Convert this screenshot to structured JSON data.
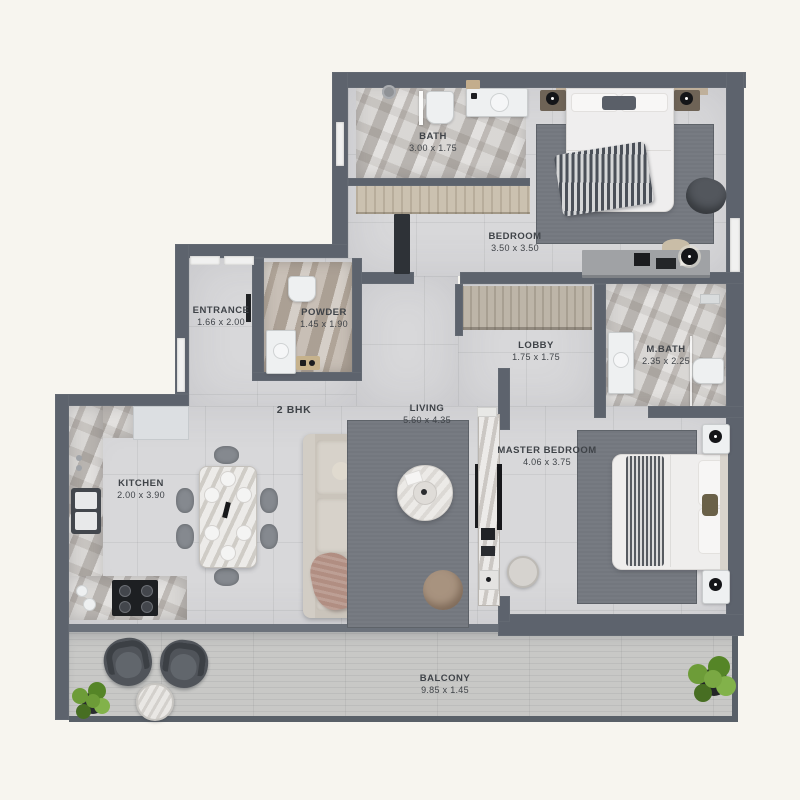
{
  "plan": {
    "unit_type": "2 BHK",
    "rooms": {
      "bath": {
        "name": "BATH",
        "dims": "3.00 x 1.75"
      },
      "bedroom": {
        "name": "BEDROOM",
        "dims": "3.50 x 3.50"
      },
      "entrance": {
        "name": "ENTRANCE",
        "dims": "1.66 x 2.00"
      },
      "powder": {
        "name": "POWDER",
        "dims": "1.45 x 1.90"
      },
      "lobby": {
        "name": "LOBBY",
        "dims": "1.75 x 1.75"
      },
      "mbath": {
        "name": "M.BATH",
        "dims": "2.35 x 2.25"
      },
      "living": {
        "name": "LIVING",
        "dims": "5.60 x 4.35"
      },
      "kitchen": {
        "name": "KITCHEN",
        "dims": "2.00 x 3.90"
      },
      "master_bedroom": {
        "name": "MASTER BEDROOM",
        "dims": "4.06 x 3.75"
      },
      "balcony": {
        "name": "BALCONY",
        "dims": "9.85 x 1.45"
      }
    },
    "colors": {
      "background": "#f7f5ef",
      "wall": "#5d636d",
      "wall_light": "#8d939c",
      "floor": "#d8d8da",
      "marble": "#c3bfbb",
      "wood": "#cbc1b0",
      "balcony_wood": "#c8c8c6",
      "rug": "#73777e",
      "plant": "#6d9c38",
      "label": "#3f4348"
    }
  }
}
